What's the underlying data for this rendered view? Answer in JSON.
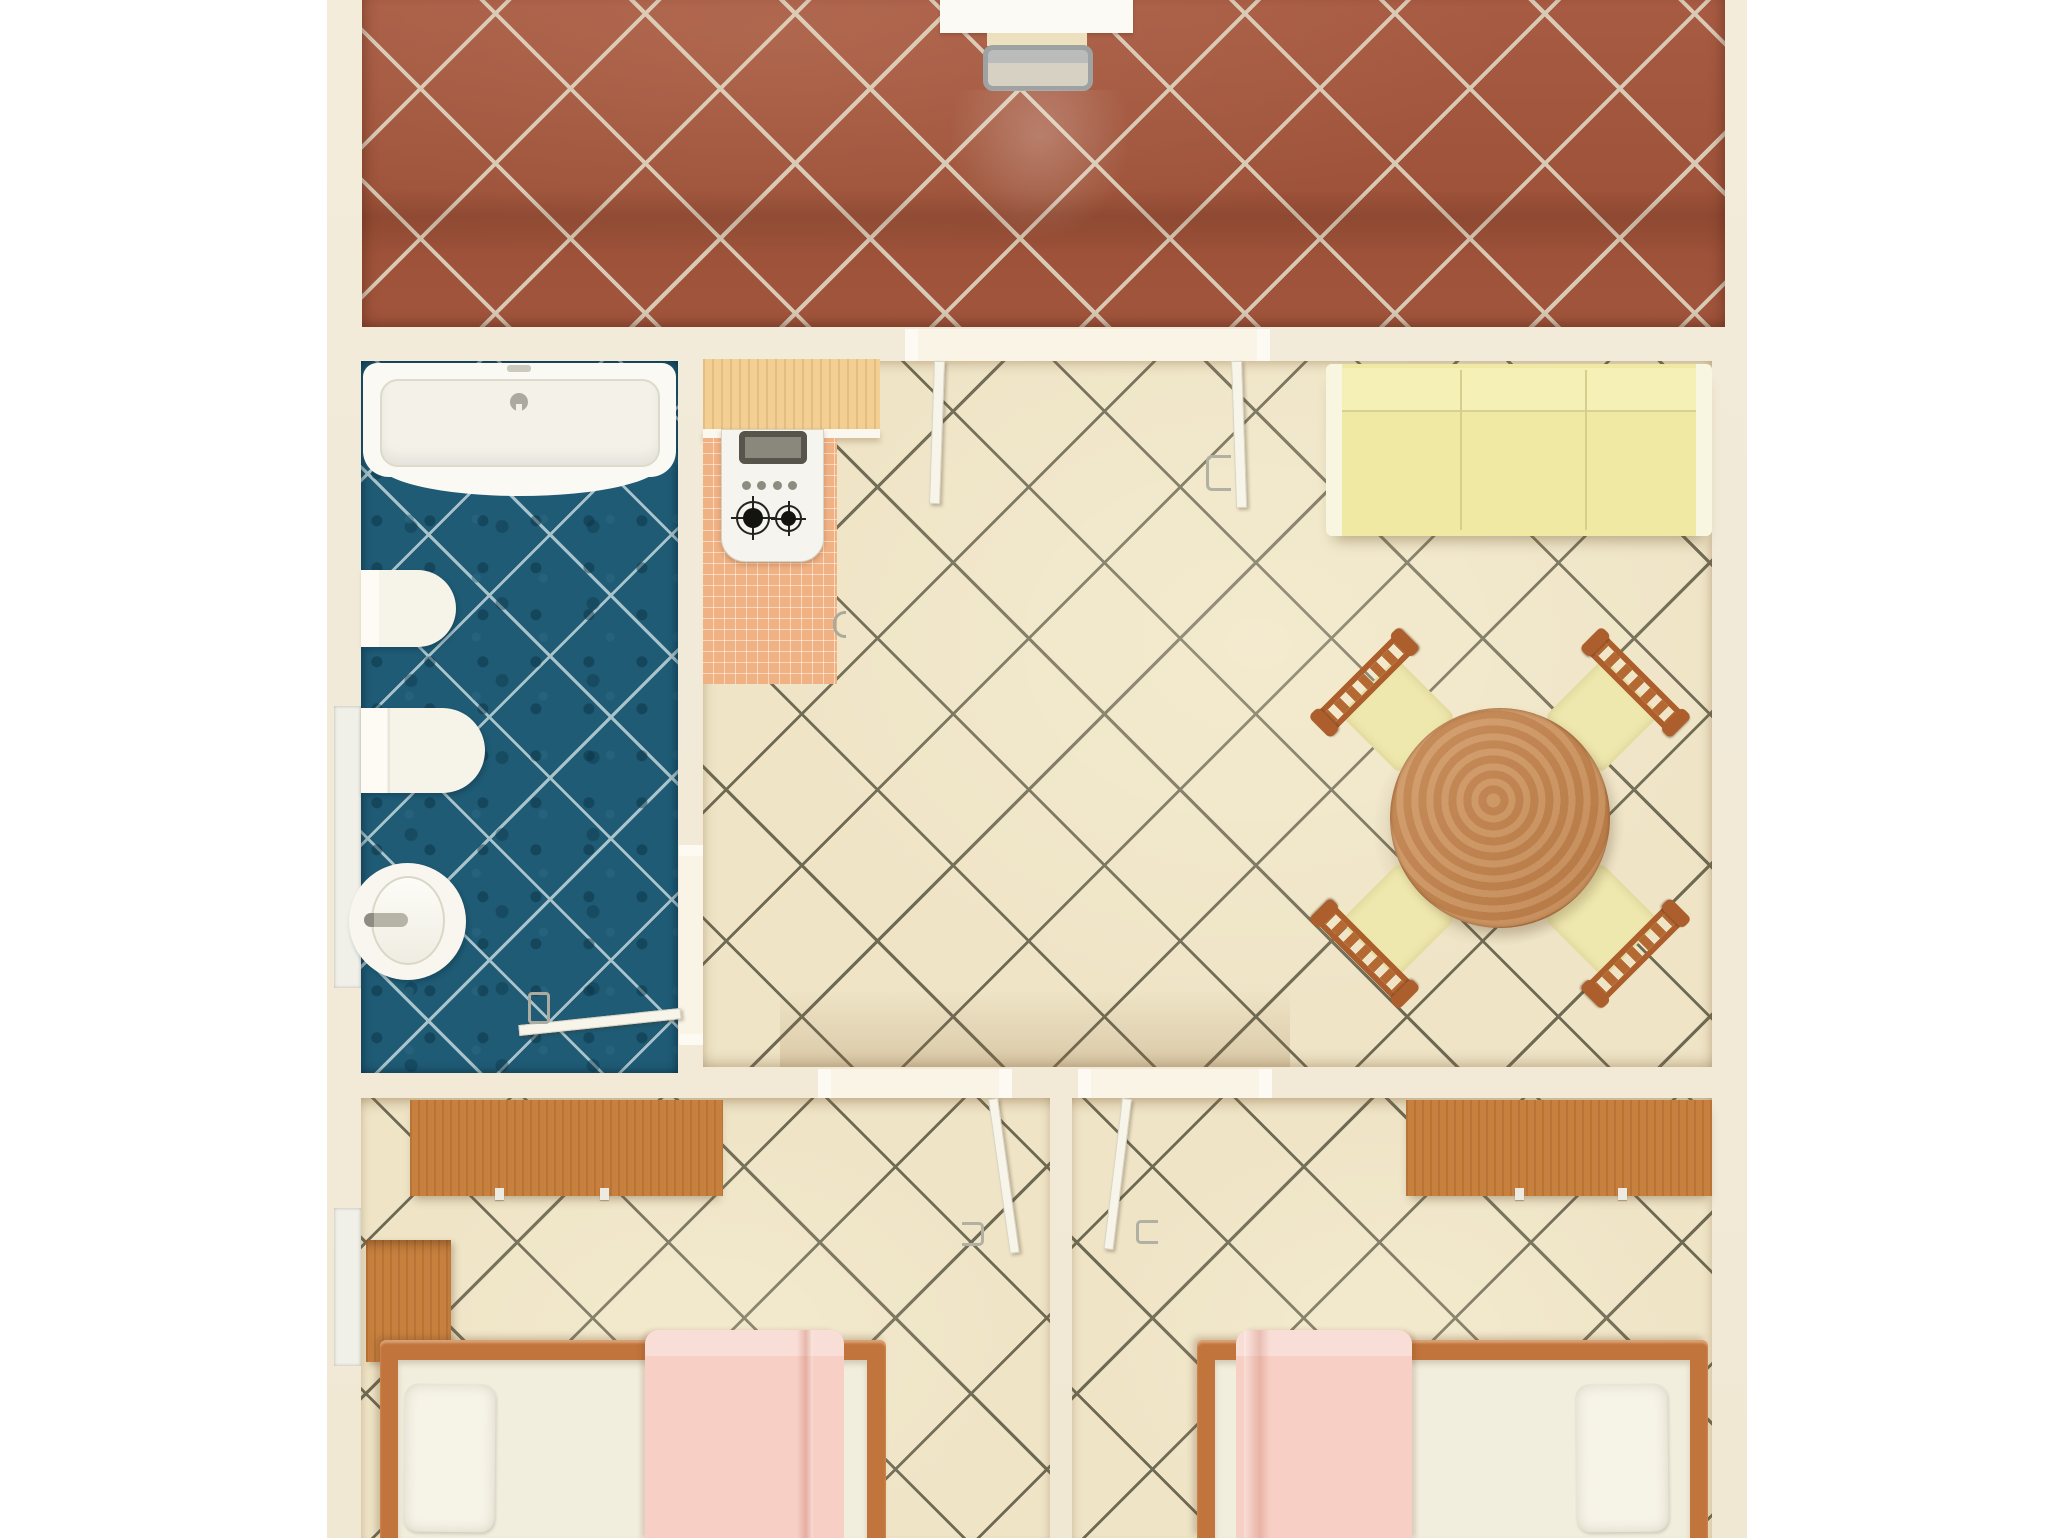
{
  "image": {
    "width": 2048,
    "height": 1538,
    "view": "top-down-3d-render-floor-plan",
    "visible_text": []
  },
  "palette": {
    "background": "#FFFFFF",
    "wall": "#F2EAD8",
    "wall-recess": "#F9F4E6",
    "terrace-tile": "#A3563F",
    "terrace-grout": "#D9CAB5",
    "floor-tile": "#EFE4C6",
    "floor-grout": "#6F6A54",
    "bath-tile": "#1F5B75",
    "bath-grout": "#A8C3C9",
    "salmon-tile": "#F0B183",
    "counter-wood": "#F3CF93",
    "fixture-white": "#F8F6EC",
    "stove-dark": "#57544C",
    "sofa-yellow": "#EFE9A4",
    "table-wood": "#C98950",
    "chair-wood": "#AC5F2C",
    "chair-seat": "#EFE8AE",
    "bed-wood": "#C1743C",
    "desk-wood": "#C8803E",
    "mattress": "#F2EEDE",
    "pillow": "#F6F3E7",
    "blanket-pink": "#F7CFC4",
    "door-white": "#F7F4EA",
    "window-glass": "#F0F0E9"
  },
  "scene": {
    "rooms": [
      {
        "id": "terrace",
        "floor": "terracotta diagonal tiles",
        "items": [
          "white-table",
          "metal-frame-bench"
        ]
      },
      {
        "id": "bathroom",
        "floor": "dark teal diagonal tiles",
        "items": [
          "bathtub",
          "toilet",
          "bidet",
          "round-washbasin",
          "open-door",
          "window"
        ]
      },
      {
        "id": "kitchen-living-room",
        "floor": "cream diagonal tiles",
        "items": [
          "wood-counter",
          "gas-stove-2-burners",
          "salmon-tile-mat",
          "three-seat-sofa",
          "round-dining-table",
          "chair-nw",
          "chair-ne",
          "chair-sw",
          "chair-se",
          "terrace-double-door-open"
        ]
      },
      {
        "id": "bedroom-left",
        "floor": "cream diagonal tiles",
        "items": [
          "wardrobe-desk",
          "nightstand",
          "single-bed",
          "pillow",
          "pink-blanket",
          "open-door",
          "window"
        ]
      },
      {
        "id": "bedroom-right",
        "floor": "cream diagonal tiles",
        "items": [
          "wardrobe-desk",
          "single-bed",
          "pillow",
          "pink-blanket",
          "open-door"
        ]
      }
    ]
  }
}
